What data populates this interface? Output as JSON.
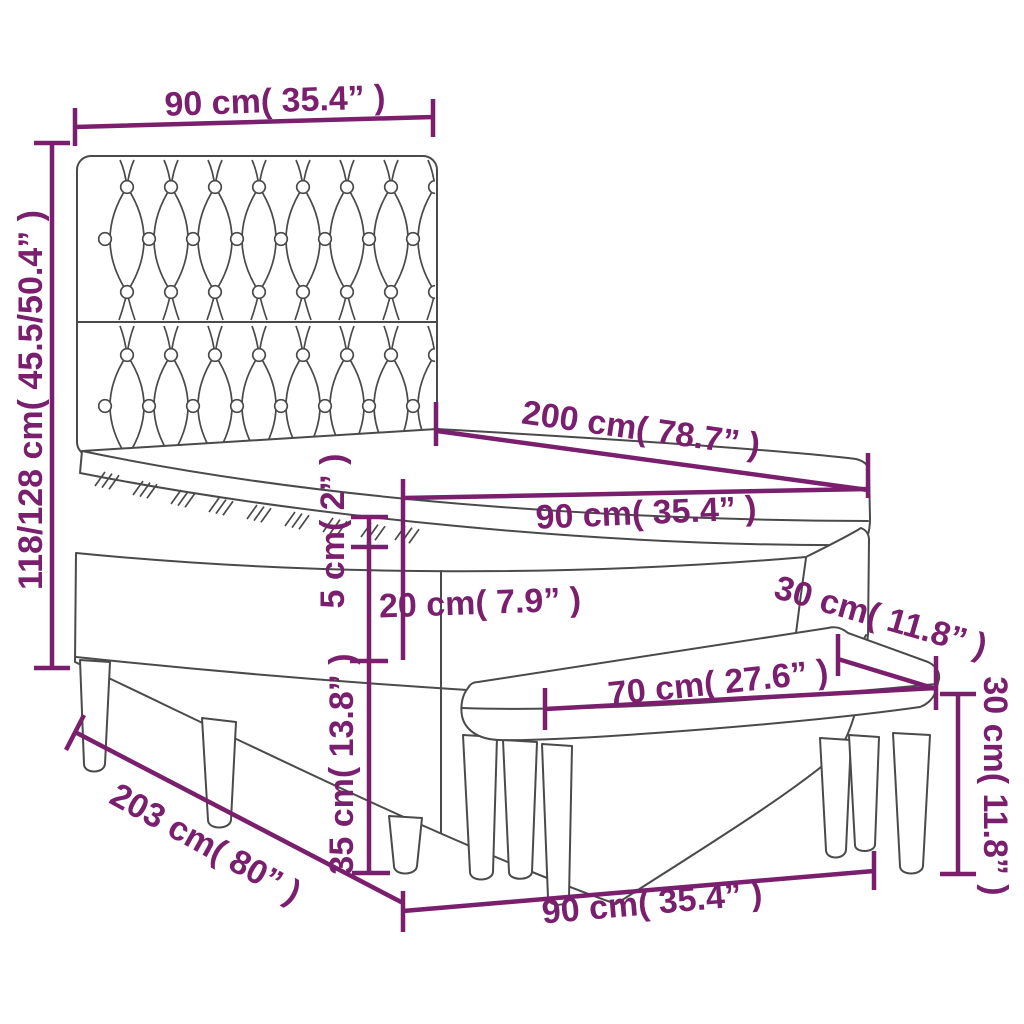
{
  "figure": {
    "type": "product-dimension-diagram",
    "subject": "box spring bed with tufted headboard, mattress topper and bench"
  },
  "colors": {
    "dimension": "#7a1e6e",
    "line_art": "#4a4a4a",
    "background": "#ffffff"
  },
  "dims": [
    {
      "name": "headboard-width",
      "label": "90 cm( 35.4” )"
    },
    {
      "name": "total-height",
      "label": "118/128 cm( 45.5/50.4” )"
    },
    {
      "name": "bed-length",
      "label": "200 cm( 78.7” )"
    },
    {
      "name": "mattress-width",
      "label": "90 cm( 35.4” )"
    },
    {
      "name": "topper-thickness",
      "label": "5 cm( 2” )"
    },
    {
      "name": "mattress-height",
      "label": "20 cm( 7.9” )"
    },
    {
      "name": "base-height",
      "label": "35 cm( 13.8” )"
    },
    {
      "name": "total-length",
      "label": "203 cm( 80” )"
    },
    {
      "name": "bed-width",
      "label": "90 cm( 35.4” )"
    },
    {
      "name": "bench-width",
      "label": "70 cm( 27.6” )"
    },
    {
      "name": "bench-depth",
      "label": "30 cm( 11.8” )"
    },
    {
      "name": "bench-height",
      "label": "30 cm( 11.8” )"
    }
  ]
}
